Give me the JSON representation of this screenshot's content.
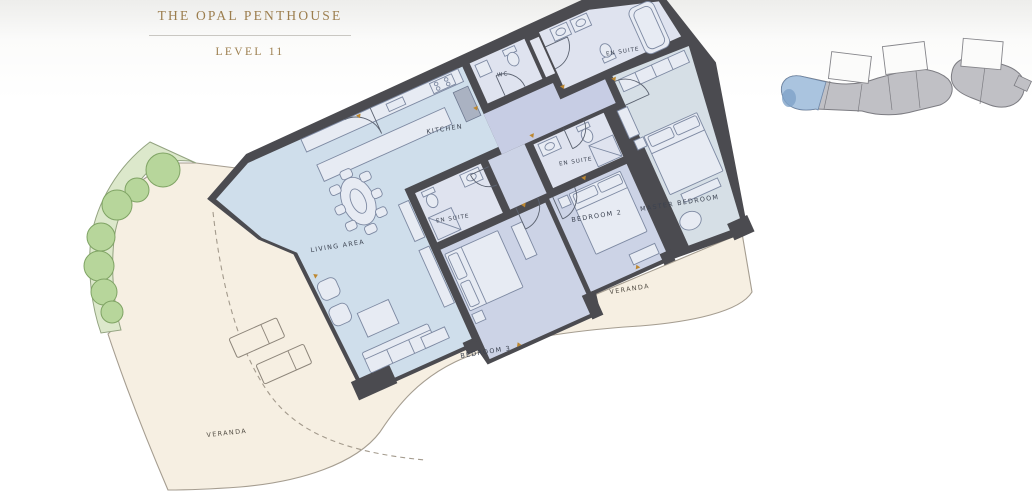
{
  "header": {
    "title": "THE OPAL PENTHOUSE",
    "level": "LEVEL 11"
  },
  "plan": {
    "rooms": {
      "kitchen": "KITCHEN",
      "living_area": "LIVING AREA",
      "wc": "WC",
      "en_suite_master": "EN SUITE",
      "en_suite_bedroom_2": "EN SUITE",
      "en_suite_bedroom_3": "EN SUITE",
      "bedroom_2": "BEDROOM 2",
      "bedroom_3": "BEDROOM 3",
      "master_bedroom": "MASTER BEDROOM"
    },
    "outdoor": {
      "veranda_main": "VERANDA",
      "veranda_rear": "VERANDA"
    }
  },
  "colors": {
    "accent_gold": "#9c7e4e",
    "wall_charcoal": "#4b4b50",
    "floor_blue": "#cfdeeb",
    "floor_lavender": "#ccd3e6",
    "floor_master": "#d6dfe6",
    "floor_hall": "#c7cde4",
    "floor_bath": "#dfe3ef",
    "veranda_cream": "#f6efe2",
    "planting_green": "#b7d69b",
    "locator_highlight": "#a9c5e1"
  }
}
